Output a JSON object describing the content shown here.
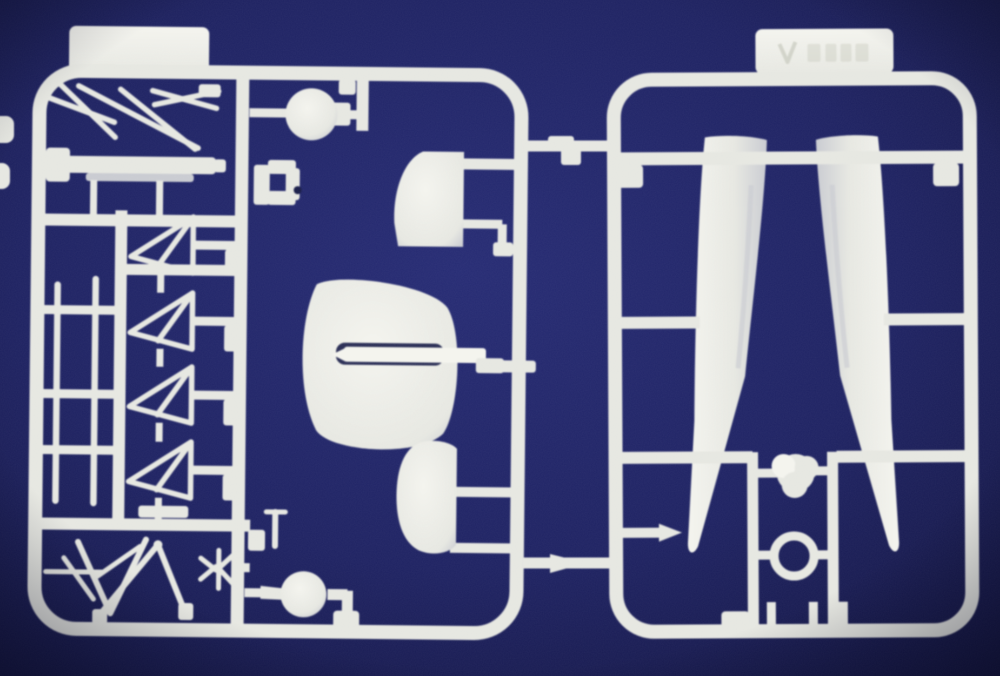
{
  "scene": {
    "subject": "Photograph of two white injection-molded plastic model kit sprues (parts frames) lying on a dark navy blue background",
    "colors": {
      "background": "#1e2262",
      "background_edge": "#121440",
      "plastic": "#e6e7e1",
      "plastic_bright": "#f4f4ee",
      "plastic_shadow": "#c9cbd1",
      "emboss": "#c9cbc0",
      "hole": "#181c48"
    }
  },
  "left_sprue": {
    "id": "small-parts-sprue",
    "tab": {
      "present": true,
      "embossed_marking_visible": false
    },
    "parts": [
      {
        "name": "diagonal-strut-bundle",
        "count": 6
      },
      {
        "name": "flat-spreader-bar",
        "count": 1
      },
      {
        "name": "long-thin-struts",
        "count": 2
      },
      {
        "name": "triangular-n-strut",
        "count": 4
      },
      {
        "name": "round-ball-part-top",
        "count": 1
      },
      {
        "name": "bracket-with-hole",
        "count": 1
      },
      {
        "name": "quarter-round-fin",
        "count": 1
      },
      {
        "name": "rounded-tailplane-with-slot",
        "count": 1
      },
      {
        "name": "stepped-spar-rod",
        "count": 1
      },
      {
        "name": "small-rounded-rudder",
        "count": 1
      },
      {
        "name": "round-ball-part-bottom",
        "count": 1
      },
      {
        "name": "k-shaped-fitting",
        "count": 1
      },
      {
        "name": "pin-fitting",
        "count": 1
      },
      {
        "name": "v-strut",
        "count": 2
      },
      {
        "name": "loose-diagonal-strut",
        "count": 3
      }
    ]
  },
  "right_sprue": {
    "id": "float-halves-sprue",
    "tab": {
      "present": true,
      "embossed_marking_visible": true,
      "embossed_marking_legible": false
    },
    "parts": [
      {
        "name": "float-half",
        "count": 2
      },
      {
        "name": "lumpy-hub-part",
        "count": 1
      },
      {
        "name": "ring-part",
        "count": 1
      },
      {
        "name": "small-pin",
        "count": 2
      },
      {
        "name": "pointed-wedge-part",
        "count": 1
      }
    ]
  },
  "connectors": {
    "between_sprues": [
      {
        "name": "top-runner-bridge-with-step-part"
      },
      {
        "name": "bottom-runner-bridge-with-pointed-part"
      }
    ],
    "image_edge_stubs": 2
  }
}
